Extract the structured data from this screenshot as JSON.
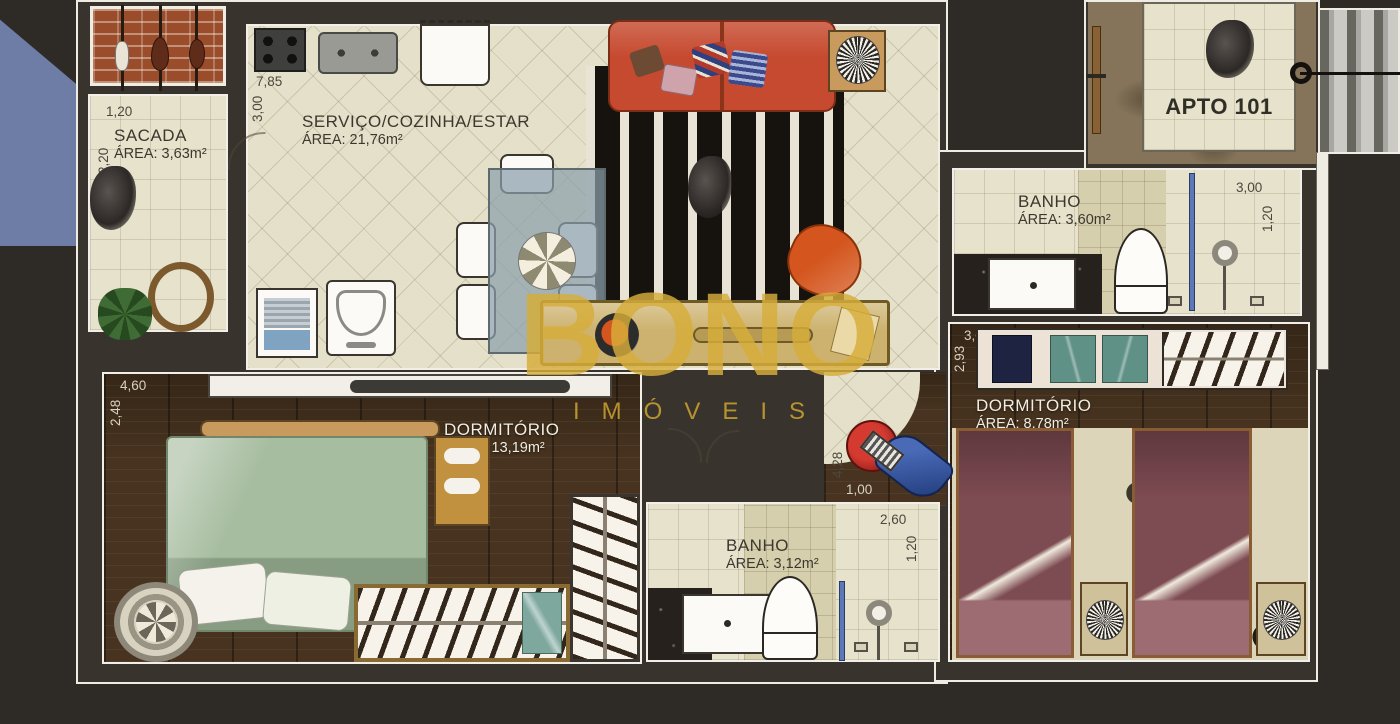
{
  "unit": {
    "label": "APTO 101"
  },
  "watermark": {
    "line1": "BONO",
    "line2": "IMÓVEIS",
    "color": "#d7ae3a"
  },
  "rooms": {
    "sacada": {
      "name": "SACADA",
      "area": "ÁREA: 3,63m²",
      "dim_w": "1,20",
      "dim_h": "2,20"
    },
    "servico": {
      "name": "SERVIÇO/COZINHA/ESTAR",
      "area": "ÁREA: 21,76m²",
      "dim_w": "7,85",
      "dim_h": "3,00"
    },
    "banho_suite": {
      "name": "BANHO",
      "area": "ÁREA: 3,60m²",
      "dim_w": "3,00",
      "dim_h": "1,20"
    },
    "dorm_casal": {
      "name": "DORMITÓRIO",
      "area": "ÁREA: 13,19m²",
      "dim_w": "4,60",
      "dim_h": "2,48"
    },
    "dorm_solteiro": {
      "name": "DORMITÓRIO",
      "area": "ÁREA: 8,78m²",
      "dim_w": "3,00",
      "dim_h": "2,93"
    },
    "banho_social": {
      "name": "BANHO",
      "area": "ÁREA: 3,12m²",
      "dim_w": "2,60",
      "dim_h": "1,20"
    }
  },
  "corridor": {
    "dim_v": "4,28",
    "dim_h": "1,00"
  },
  "colors": {
    "tile": "#e5e0c9",
    "wood": "#47331f",
    "wall": "#39332e",
    "sofa": "#c64a2f",
    "corner_triangle": "#6e7da5",
    "watermark_gold": "#d7ae3a"
  }
}
